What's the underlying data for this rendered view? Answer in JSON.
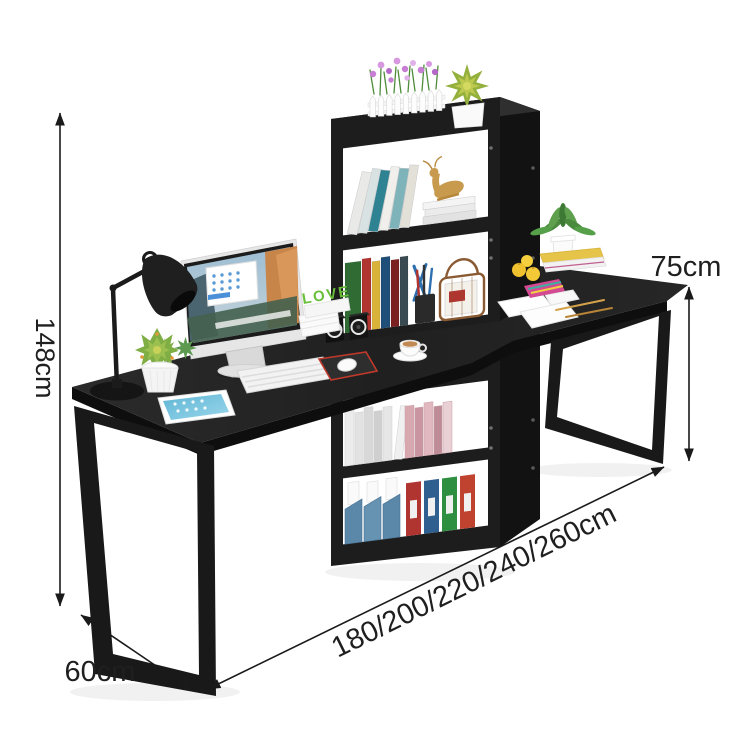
{
  "annotations": {
    "overall_height": "148cm",
    "desktop_height": "75cm",
    "desk_depth": "60cm",
    "width_options": "180/200/220/240/260cm"
  },
  "scene": {
    "love_decor_text": "LOVE",
    "objects": [
      "two-person-computer-desk",
      "center-bookshelf-tower",
      "monitor",
      "desk-lamp",
      "white-keyboard",
      "tablet",
      "mouse-on-mousepad",
      "succulent-plants",
      "picket-fence-planter",
      "coffee-cup",
      "cube-speakers",
      "books",
      "wire-basket",
      "blue-file-boxes",
      "ring-binders",
      "lemons",
      "papers-and-pencils",
      "potted-plant-on-books",
      "gold-deer-figurine"
    ],
    "colors": {
      "background": "#ffffff",
      "desk_black": "#1e1e1e",
      "annotation_text": "#1a1a1a",
      "love_green": "#6abf3a",
      "mousepad_trim_red": "#c0392b",
      "file_box_blue": "#5b87a8",
      "binders": [
        "#b03430",
        "#2e5f8f",
        "#2e8f40",
        "#c04330"
      ]
    }
  }
}
